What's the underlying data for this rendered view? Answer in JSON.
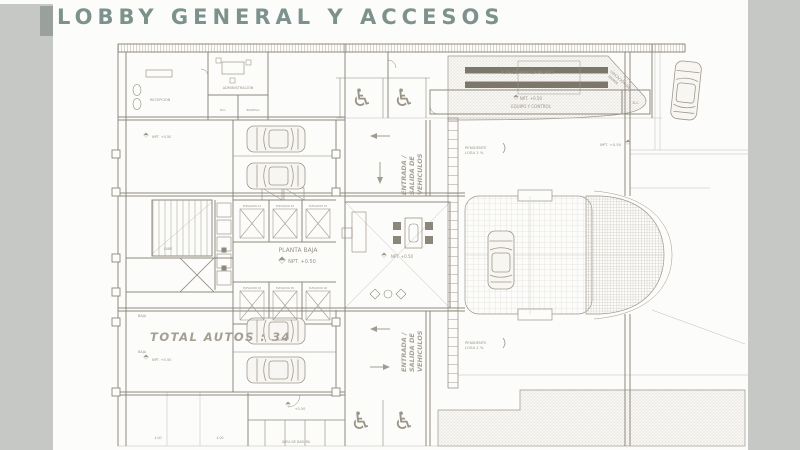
{
  "slide": {
    "title": "LOBBY GENERAL Y ACCESOS",
    "accent_color": "#7d928e",
    "sidebar_color": "#c6c8c6",
    "line_color": "#9e978c",
    "speed_bump_color": "#7d776b"
  },
  "plan": {
    "total_autos": "TOTAL AUTOS : 34",
    "planta_baja": "PLANTA BAJA",
    "npt": "NPT. +0.50",
    "npt_short": "+0.50",
    "vehicle_access": {
      "l1": "ENTRADA /",
      "l2": "SALIDA DE",
      "l3": "VEHICULOS"
    },
    "slope": {
      "l1": "PENDIENTE",
      "l2": "LOSA 2 %"
    },
    "ramp_note": {
      "l1": "UBICACIÓN DE",
      "l2": "RAMPA"
    },
    "rooms": {
      "recepcion": "RECEPCIÓN",
      "administracion": "ADMINISTRACIÓN",
      "wc": "W.C.",
      "bodega": "BODEGA",
      "ruta": "RUTA DE MANTENIMIENTO",
      "equipo": "EQUIPO Y CONTROL",
      "bc": "B.C.",
      "basura": "ÁREA DE BASURA"
    },
    "stairs": {
      "sube": "SUBE",
      "baja": "BAJA"
    },
    "dim": "4.00",
    "elevators": [
      "ELEVADOR 01",
      "ELEVADOR 02",
      "ELEVADOR 03",
      "ELEVADOR 04",
      "ELEVADOR 05",
      "ELEVADOR 06"
    ],
    "icons": {
      "wheelchair": "♿"
    }
  }
}
